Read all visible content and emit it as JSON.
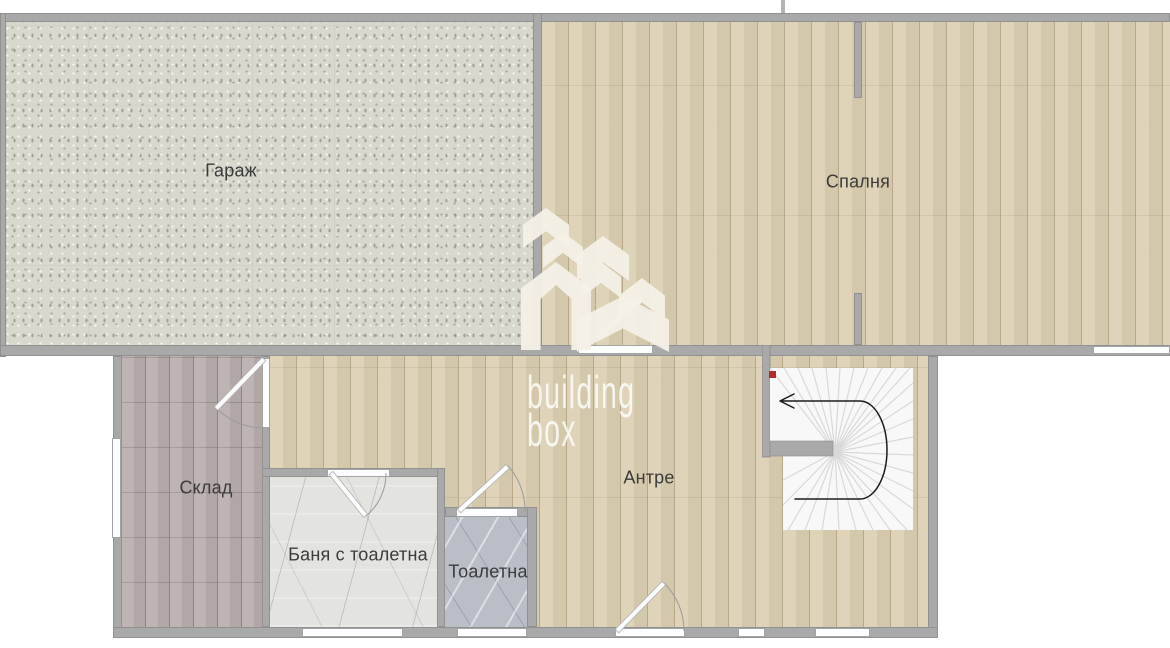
{
  "plan": {
    "type": "floor-plan",
    "rooms": {
      "garage": {
        "label": "Гараж"
      },
      "bedroom": {
        "label": "Спалня"
      },
      "storage": {
        "label": "Склад"
      },
      "bathroom": {
        "label": "Баня с тоалетна"
      },
      "toilet": {
        "label": "Тоалетна"
      },
      "hallway": {
        "label": "Антре"
      }
    }
  },
  "watermark": {
    "brand_line1": "building",
    "brand_line2": "box"
  },
  "colors": {
    "wall": "#a9a9a9",
    "garage_floor": "#d8d8cd",
    "wood_floor": "#dbceb1",
    "storage_floor": "#b9aeae",
    "bathroom_floor": "#e3e3e0",
    "toilet_floor": "#b9bec7",
    "stairs_fill": "#f8f8f8",
    "stairs_step_line": "#d8d8d8",
    "stairs_arrow": "#1c1c1c",
    "stairs_start_marker": "#b02c2c",
    "label_text": "#3b3b3b",
    "watermark_text": "#fdfdfa"
  }
}
